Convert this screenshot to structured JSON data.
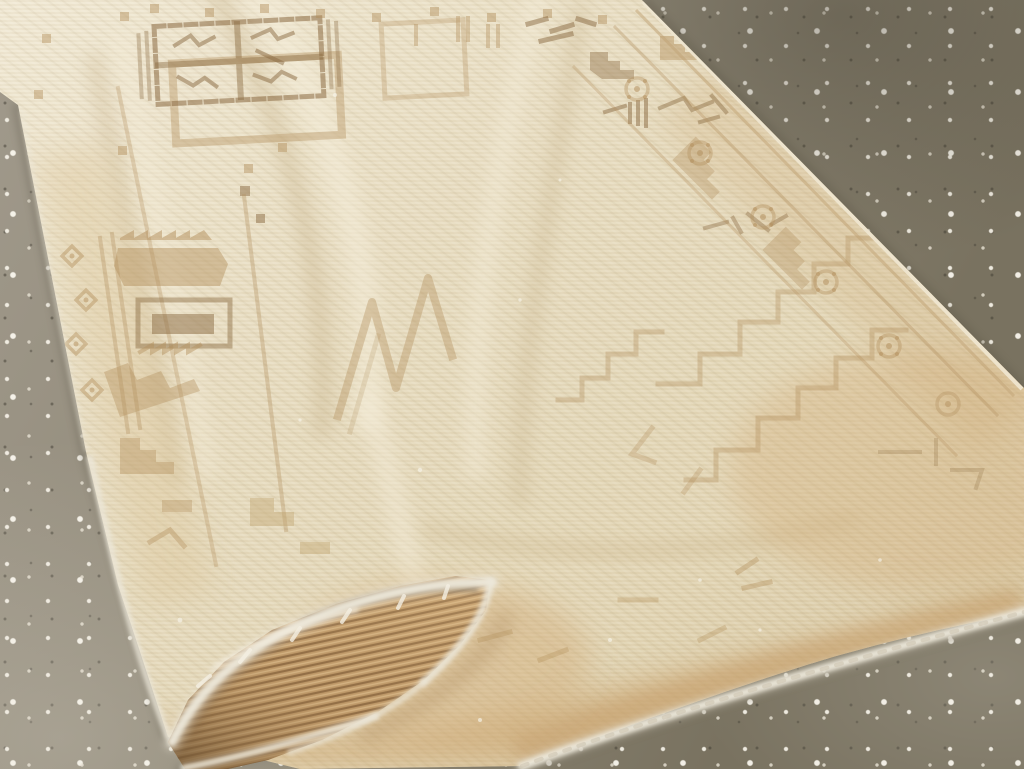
{
  "image": {
    "kind": "photograph",
    "caption": "Angled overhead photograph of a worn vintage hand-knotted rug in faded cream, beige and tan with geometric Anatolian motifs, lying diagonally on a speckled gray terrazzo concrete floor; the near corner is flipped over, exposing the ribbed woven back and frayed white selvedge edges.",
    "objects": [
      {
        "name": "vintage-rug",
        "label": "Faded cream and tan geometric rug"
      },
      {
        "name": "rug-fold-flap",
        "label": "Folded-over corner showing ribbed rug back"
      },
      {
        "name": "selvedge-fringe",
        "label": "Frayed white selvedge edge"
      },
      {
        "name": "terrazzo-floor",
        "label": "Speckled gray-brown terrazzo concrete floor"
      }
    ]
  },
  "palette": {
    "floor_base": "#8e8776",
    "floor_dark": "#797260",
    "floor_light": "#a19a8c",
    "rug_field": "#e7dcc0",
    "rug_field_light": "#f2e9d4",
    "rug_field_dark": "#d7c6a2",
    "motif_tan": "#b3905e",
    "motif_brown": "#8a6a41",
    "bottom_tan": "#c9a26c",
    "flap_back": "#bf9a6a",
    "flap_rib": "#96713f",
    "selvedge_white": "#ece7d9",
    "shadow": "#55503f"
  }
}
